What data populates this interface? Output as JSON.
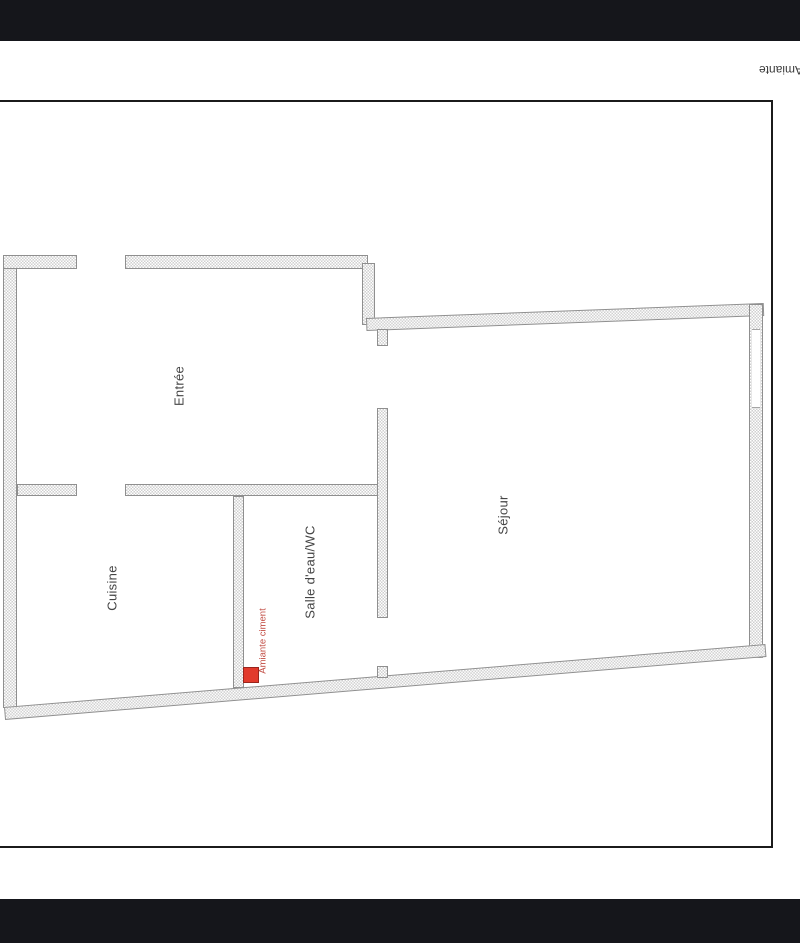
{
  "header": {
    "rotated_title": "Amiante"
  },
  "floor_plan": {
    "rooms": [
      {
        "id": "entree",
        "label": "Entrée"
      },
      {
        "id": "cuisine",
        "label": "Cuisine"
      },
      {
        "id": "salle-eau-wc",
        "label": "Salle d'eau/WC"
      },
      {
        "id": "sejour",
        "label": "Séjour"
      }
    ],
    "annotation": {
      "label": "Amiante ciment"
    }
  },
  "colors": {
    "bar_dark": "#15161b",
    "frame_black": "#1b1b1b",
    "wall_check": "#cfcfcf",
    "wall_edge": "#8f8f8f",
    "label_gray": "#454545",
    "hazard_red": "#e23a2c",
    "hazard_border": "#99251d",
    "annotation_red": "#c14b42"
  }
}
